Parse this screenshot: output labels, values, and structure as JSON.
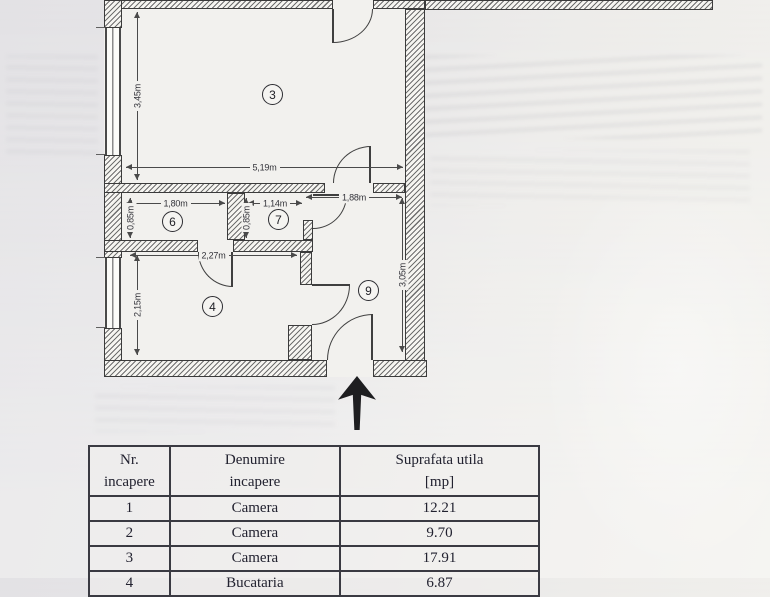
{
  "plan": {
    "rooms": {
      "room3": {
        "label": "3"
      },
      "room4": {
        "label": "4"
      },
      "room6": {
        "label": "6"
      },
      "room7": {
        "label": "7"
      },
      "room9": {
        "label": "9"
      }
    },
    "dimensions": {
      "room3_width": "5,19m",
      "room3_height": "3,45m",
      "room6_width": "1,80m",
      "room6_height": "0,85m",
      "room7_width": "1,14m",
      "room7_height": "0,85m",
      "hall_width": "1,88m",
      "room4_width": "2,27m",
      "room4_height": "2,15m",
      "hall_height": "3,05m"
    }
  },
  "table": {
    "headers": {
      "col1": [
        "Nr.",
        "incapere"
      ],
      "col2": [
        "Denumire",
        "incapere"
      ],
      "col3": [
        "Suprafata utila",
        "[mp]"
      ]
    },
    "rows": [
      {
        "nr": "1",
        "denumire": "Camera",
        "suprafata": "12.21"
      },
      {
        "nr": "2",
        "denumire": "Camera",
        "suprafata": "9.70"
      },
      {
        "nr": "3",
        "denumire": "Camera",
        "suprafata": "17.91"
      },
      {
        "nr": "4",
        "denumire": "Bucataria",
        "suprafata": "6.87"
      }
    ]
  }
}
